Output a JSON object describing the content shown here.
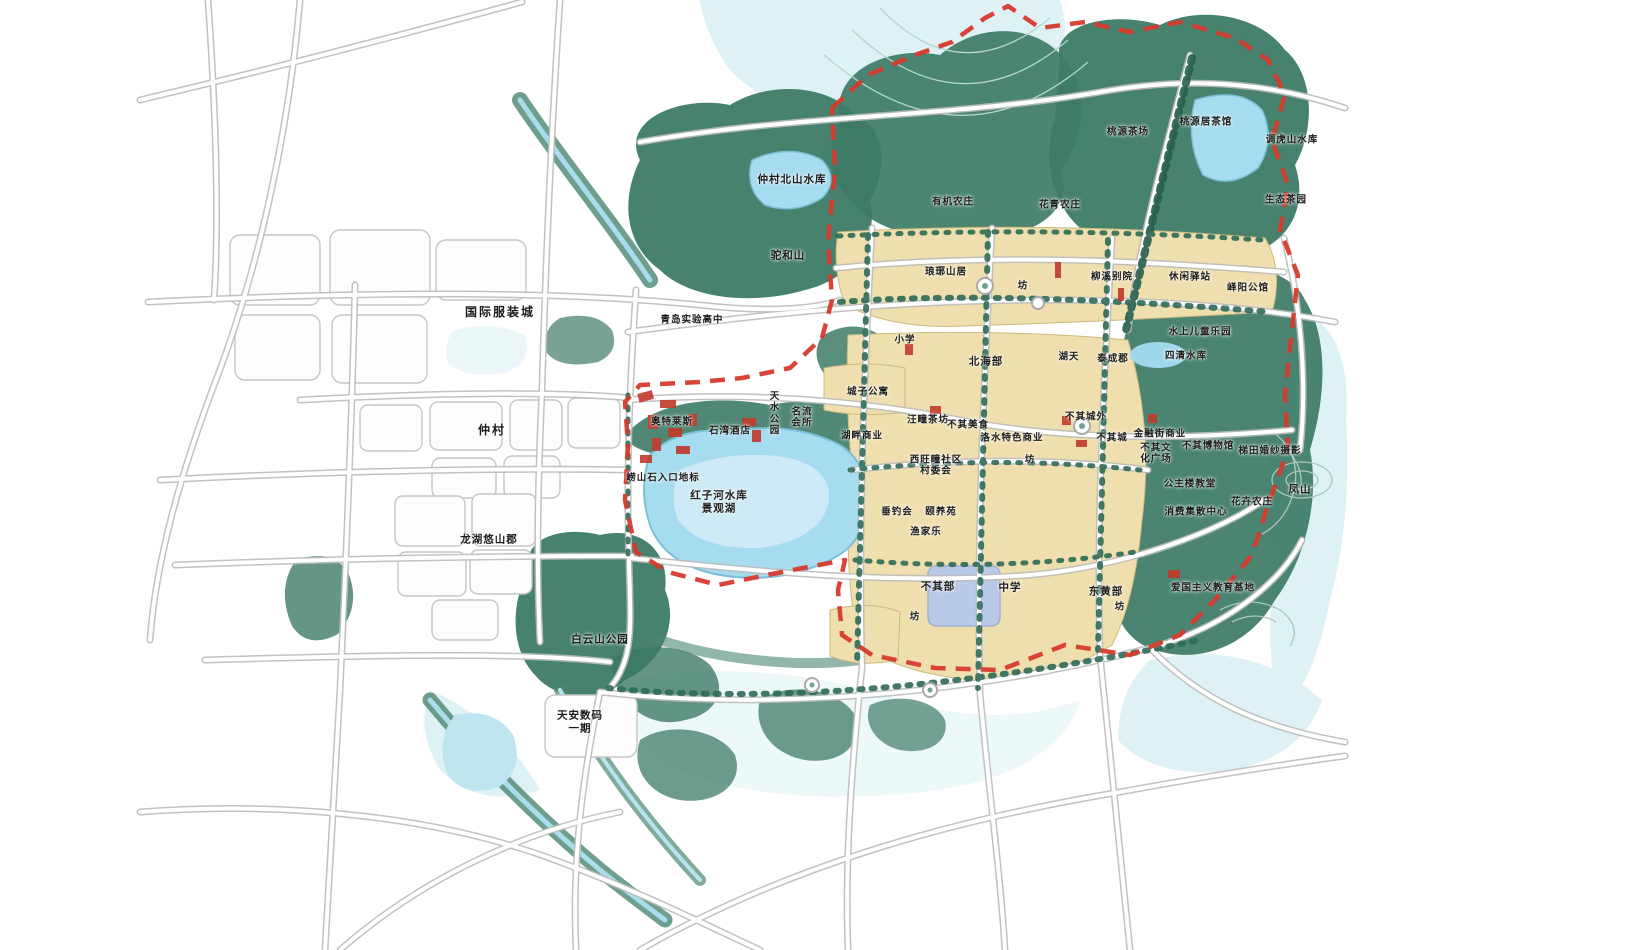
{
  "map": {
    "type": "urban-master-plan",
    "style": "hand-drawn watercolor planning map",
    "colors": {
      "background": "#ffffff",
      "forest": "#3d7b66",
      "forest_dark": "#2d6552",
      "light_green": "#8db7a5",
      "urban_block_beige": "#f0dfae",
      "water": "#a6dcef",
      "water_light": "#d8eff3",
      "road_casing": "#bcbcbc",
      "road_fill": "#ffffff",
      "boundary_red_dashed": "#d63a2c",
      "red_buildings": "#c03a2b",
      "label_text": "#1b1b1b"
    },
    "legend": "none visible",
    "labels": [
      {
        "text": "国际服装城",
        "x": 500,
        "y": 312,
        "cls": "big"
      },
      {
        "text": "青岛实验高中",
        "x": 692,
        "y": 320,
        "cls": "small"
      },
      {
        "text": "仲村",
        "x": 492,
        "y": 430,
        "cls": "big"
      },
      {
        "text": "龙湖悠山郡",
        "x": 489,
        "y": 540,
        "cls": ""
      },
      {
        "text": "白云山公园",
        "x": 600,
        "y": 640,
        "cls": ""
      },
      {
        "text": "天安数码\n一期",
        "x": 580,
        "y": 722,
        "cls": ""
      },
      {
        "text": "仲村北山水库",
        "x": 792,
        "y": 180,
        "cls": ""
      },
      {
        "text": "驼和山",
        "x": 788,
        "y": 256,
        "cls": ""
      },
      {
        "text": "有机农庄",
        "x": 953,
        "y": 202,
        "cls": "small"
      },
      {
        "text": "花青农庄",
        "x": 1060,
        "y": 205,
        "cls": "small"
      },
      {
        "text": "桃源茶场",
        "x": 1128,
        "y": 132,
        "cls": "small"
      },
      {
        "text": "桃源居茶馆",
        "x": 1206,
        "y": 122,
        "cls": "small"
      },
      {
        "text": "调虎山水库",
        "x": 1292,
        "y": 140,
        "cls": "small"
      },
      {
        "text": "生态茶园",
        "x": 1286,
        "y": 200,
        "cls": "small"
      },
      {
        "text": "琅琊山居",
        "x": 946,
        "y": 272,
        "cls": "small"
      },
      {
        "text": "坊",
        "x": 1023,
        "y": 286,
        "cls": "small"
      },
      {
        "text": "柳溪别院",
        "x": 1112,
        "y": 277,
        "cls": "small"
      },
      {
        "text": "休闲驿站",
        "x": 1190,
        "y": 277,
        "cls": "small"
      },
      {
        "text": "峄阳公馆",
        "x": 1248,
        "y": 288,
        "cls": "small"
      },
      {
        "text": "小学",
        "x": 905,
        "y": 340,
        "cls": "small"
      },
      {
        "text": "北海部",
        "x": 986,
        "y": 362,
        "cls": ""
      },
      {
        "text": "湖天",
        "x": 1069,
        "y": 357,
        "cls": "small"
      },
      {
        "text": "泰成郡",
        "x": 1113,
        "y": 359,
        "cls": "small"
      },
      {
        "text": "水上儿童乐园",
        "x": 1200,
        "y": 332,
        "cls": "small"
      },
      {
        "text": "四清水库",
        "x": 1186,
        "y": 356,
        "cls": "small"
      },
      {
        "text": "城子公寓",
        "x": 868,
        "y": 392,
        "cls": "small"
      },
      {
        "text": "奥特莱斯",
        "x": 672,
        "y": 422,
        "cls": "small"
      },
      {
        "text": "石湾酒店",
        "x": 730,
        "y": 431,
        "cls": "small"
      },
      {
        "text": "天\n水\n公\n园",
        "x": 775,
        "y": 414,
        "cls": "small"
      },
      {
        "text": "名流\n会所",
        "x": 802,
        "y": 418,
        "cls": "small"
      },
      {
        "text": "湖畔商业",
        "x": 862,
        "y": 436,
        "cls": "small"
      },
      {
        "text": "汪疃茶坊",
        "x": 928,
        "y": 420,
        "cls": "small"
      },
      {
        "text": "不其美食",
        "x": 968,
        "y": 425,
        "cls": "small"
      },
      {
        "text": "洛水特色商业",
        "x": 1012,
        "y": 438,
        "cls": "small"
      },
      {
        "text": "不其城外",
        "x": 1086,
        "y": 417,
        "cls": "small"
      },
      {
        "text": "不其城",
        "x": 1112,
        "y": 438,
        "cls": "small"
      },
      {
        "text": "金融街商业",
        "x": 1160,
        "y": 434,
        "cls": "small"
      },
      {
        "text": "不其文\n化广场",
        "x": 1156,
        "y": 454,
        "cls": "small"
      },
      {
        "text": "不其博物馆",
        "x": 1208,
        "y": 446,
        "cls": "small"
      },
      {
        "text": "梯田婚纱摄影",
        "x": 1270,
        "y": 451,
        "cls": "small"
      },
      {
        "text": "公主楼教堂",
        "x": 1190,
        "y": 484,
        "cls": "small"
      },
      {
        "text": "花卉农庄",
        "x": 1252,
        "y": 502,
        "cls": "small"
      },
      {
        "text": "消费集散中心",
        "x": 1196,
        "y": 512,
        "cls": "small"
      },
      {
        "text": "西旺疃社区\n村委会",
        "x": 936,
        "y": 466,
        "cls": "small"
      },
      {
        "text": "坊",
        "x": 1030,
        "y": 460,
        "cls": "small"
      },
      {
        "text": "垂钓会",
        "x": 897,
        "y": 512,
        "cls": "small"
      },
      {
        "text": "颐养苑",
        "x": 941,
        "y": 512,
        "cls": "small"
      },
      {
        "text": "渔家乐",
        "x": 926,
        "y": 532,
        "cls": "small"
      },
      {
        "text": "崂山石入口地标",
        "x": 663,
        "y": 478,
        "cls": "small"
      },
      {
        "text": "红子河水库\n景观湖",
        "x": 719,
        "y": 502,
        "cls": ""
      },
      {
        "text": "不其部",
        "x": 938,
        "y": 587,
        "cls": ""
      },
      {
        "text": "中学",
        "x": 1010,
        "y": 588,
        "cls": ""
      },
      {
        "text": "东黄部",
        "x": 1106,
        "y": 592,
        "cls": ""
      },
      {
        "text": "坊",
        "x": 1120,
        "y": 607,
        "cls": "small"
      },
      {
        "text": "坊",
        "x": 915,
        "y": 617,
        "cls": "small"
      },
      {
        "text": "爱国主义教育基地",
        "x": 1213,
        "y": 588,
        "cls": "small"
      },
      {
        "text": "凤山",
        "x": 1300,
        "y": 490,
        "cls": ""
      }
    ]
  }
}
